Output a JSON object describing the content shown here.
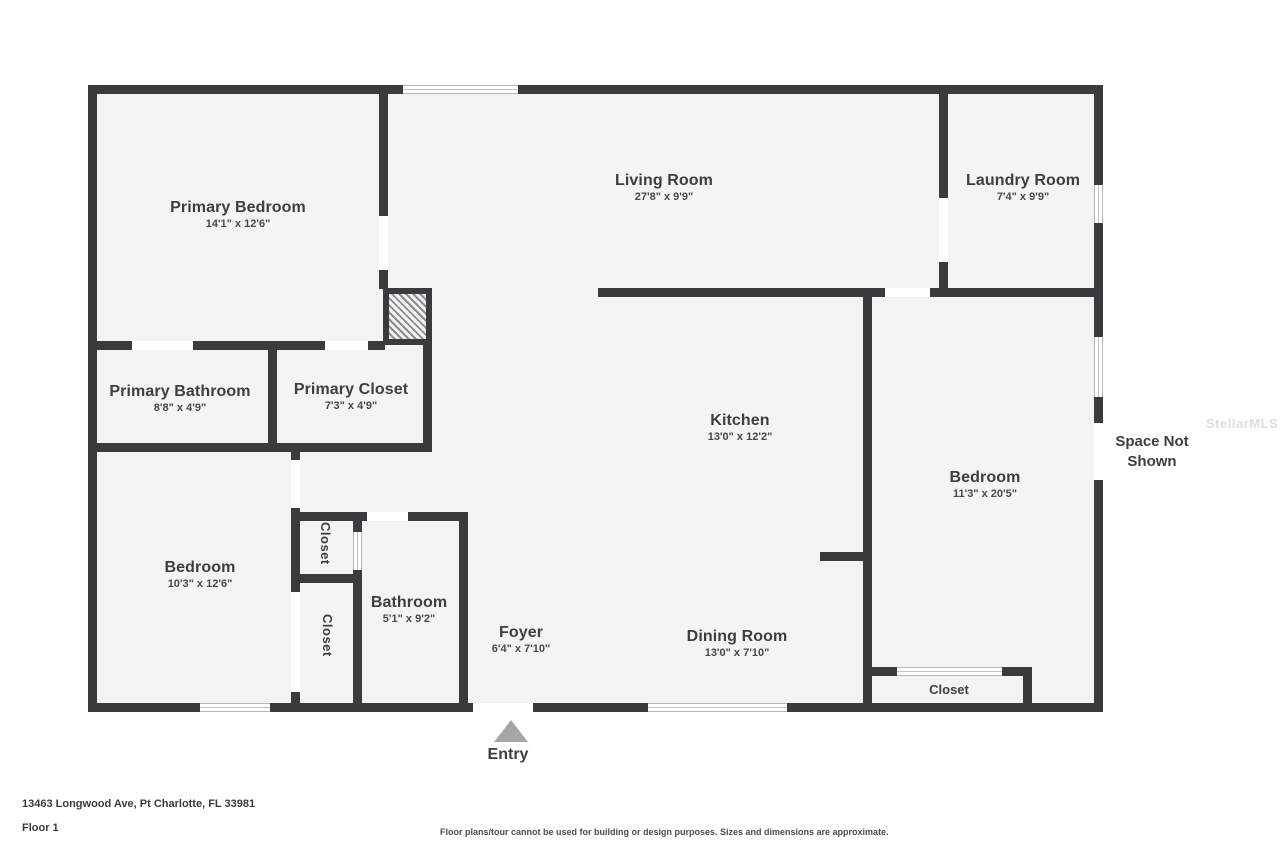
{
  "plan": {
    "rooms": {
      "primary_bedroom": {
        "name": "Primary Bedroom",
        "dims": "14'1\" x 12'6\""
      },
      "living_room": {
        "name": "Living Room",
        "dims": "27'8\" x 9'9\""
      },
      "laundry_room": {
        "name": "Laundry Room",
        "dims": "7'4\" x 9'9\""
      },
      "primary_bathroom": {
        "name": "Primary Bathroom",
        "dims": "8'8\" x 4'9\""
      },
      "primary_closet": {
        "name": "Primary Closet",
        "dims": "7'3\" x 4'9\""
      },
      "kitchen": {
        "name": "Kitchen",
        "dims": "13'0\" x 12'2\""
      },
      "bedroom_right": {
        "name": "Bedroom",
        "dims": "11'3\" x 20'5\""
      },
      "bedroom_left": {
        "name": "Bedroom",
        "dims": "10'3\" x 12'6\""
      },
      "bathroom": {
        "name": "Bathroom",
        "dims": "5'1\" x 9'2\""
      },
      "foyer": {
        "name": "Foyer",
        "dims": "6'4\" x 7'10\""
      },
      "dining_room": {
        "name": "Dining Room",
        "dims": "13'0\" x 7'10\""
      }
    },
    "closets": {
      "upper": "Closet",
      "lower": "Closet",
      "bedroom": "Closet"
    },
    "space_not_shown": "Space Not Shown",
    "entry": "Entry",
    "watermark": "StellarMLS"
  },
  "footer": {
    "address": "13463 Longwood Ave, Pt Charlotte, FL 33981",
    "floor": "Floor 1",
    "disclaimer": "Floor plans/tour cannot be used for building or design purposes. Sizes and dimensions are approximate."
  },
  "colors": {
    "wall": "#3b3b3d",
    "floor": "#f4f4f5",
    "text": "#3e3e40",
    "entry_arrow": "#a6a6a8"
  }
}
